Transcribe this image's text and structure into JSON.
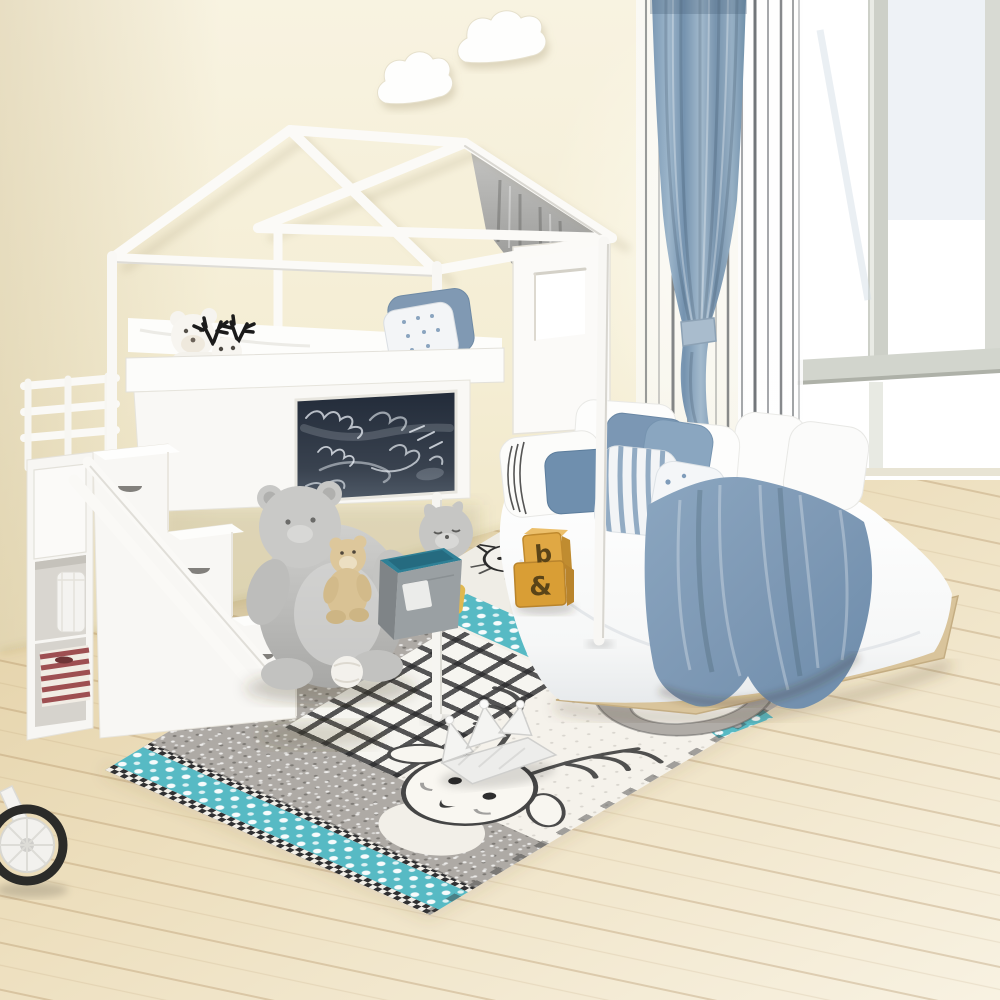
{
  "meta": {
    "scene_description": "Product-style photo of a kids bedroom: white house-frame loft bed with chalkboard panel and storage staircase, floor mattress with blue bedding, patchwork animal rug, plush toys, blue curtain and bright window",
    "canvas": {
      "width": 1000,
      "height": 1000
    }
  },
  "colors": {
    "wall": "#f5efd9",
    "wall_shade": "#e9debe",
    "floor": "#ead9b2",
    "floor_light": "#f7f0e0",
    "frame_white": "#fbfaf7",
    "frame_edge": "#d9d6cc",
    "curtain_blue": "#8aa6bf",
    "curtain_blue_dark": "#6f8fa9",
    "sheer_stripe": "#3c4146",
    "window_glass": "#ffffff",
    "window_frame": "#cdd0c8",
    "chalkboard": "#29323f",
    "chalk": "#e8eef4",
    "pillow_blue": "#7b97b4",
    "pillow_blue_deep": "#6f8fae",
    "blanket_blue": "#7e99b5",
    "rug_white": "#f4f1ea",
    "rug_gray": "#aeaaa5",
    "rug_teal": "#57bac4",
    "sketch_ink": "#454545",
    "chair_gray": "#c6c6c4",
    "teddy_beige": "#d9c294",
    "plush_white": "#f6f4ef",
    "antler_black": "#1b1b1b",
    "cube_gray": "#9aa0a3",
    "cube_teal": "#2f8096",
    "block_yellow": "#dda63e",
    "block_ink": "#5a4418",
    "basket_red": "#9e4f52",
    "wood_platform": "#d9c49b",
    "tire_black": "#2b2b29"
  },
  "toys": {
    "block_top_letter": "b",
    "block_bottom_letter": "&"
  },
  "scene": {
    "objects": [
      "wall-cloud-decals",
      "house-frame-loft-bed",
      "roof-gray-curtain",
      "loft-chalkboard-panel",
      "loft-guardrail",
      "white-teddy-bear",
      "reindeer-plush",
      "loft-pillows",
      "loft-folded-blanket",
      "storage-staircase",
      "cubby-canister",
      "striped-basket",
      "floor-mattress",
      "floor-pillows",
      "floor-blanket",
      "patchwork-rug",
      "rug-bear-motif",
      "rug-deer-motif",
      "bear-armchair",
      "beige-teddy-bear",
      "felt-storage-cube",
      "cat-plush",
      "alphabet-blocks",
      "crown-cushion",
      "tricycle-wheel",
      "blue-curtain",
      "sheer-striped-curtain",
      "bright-window"
    ]
  }
}
